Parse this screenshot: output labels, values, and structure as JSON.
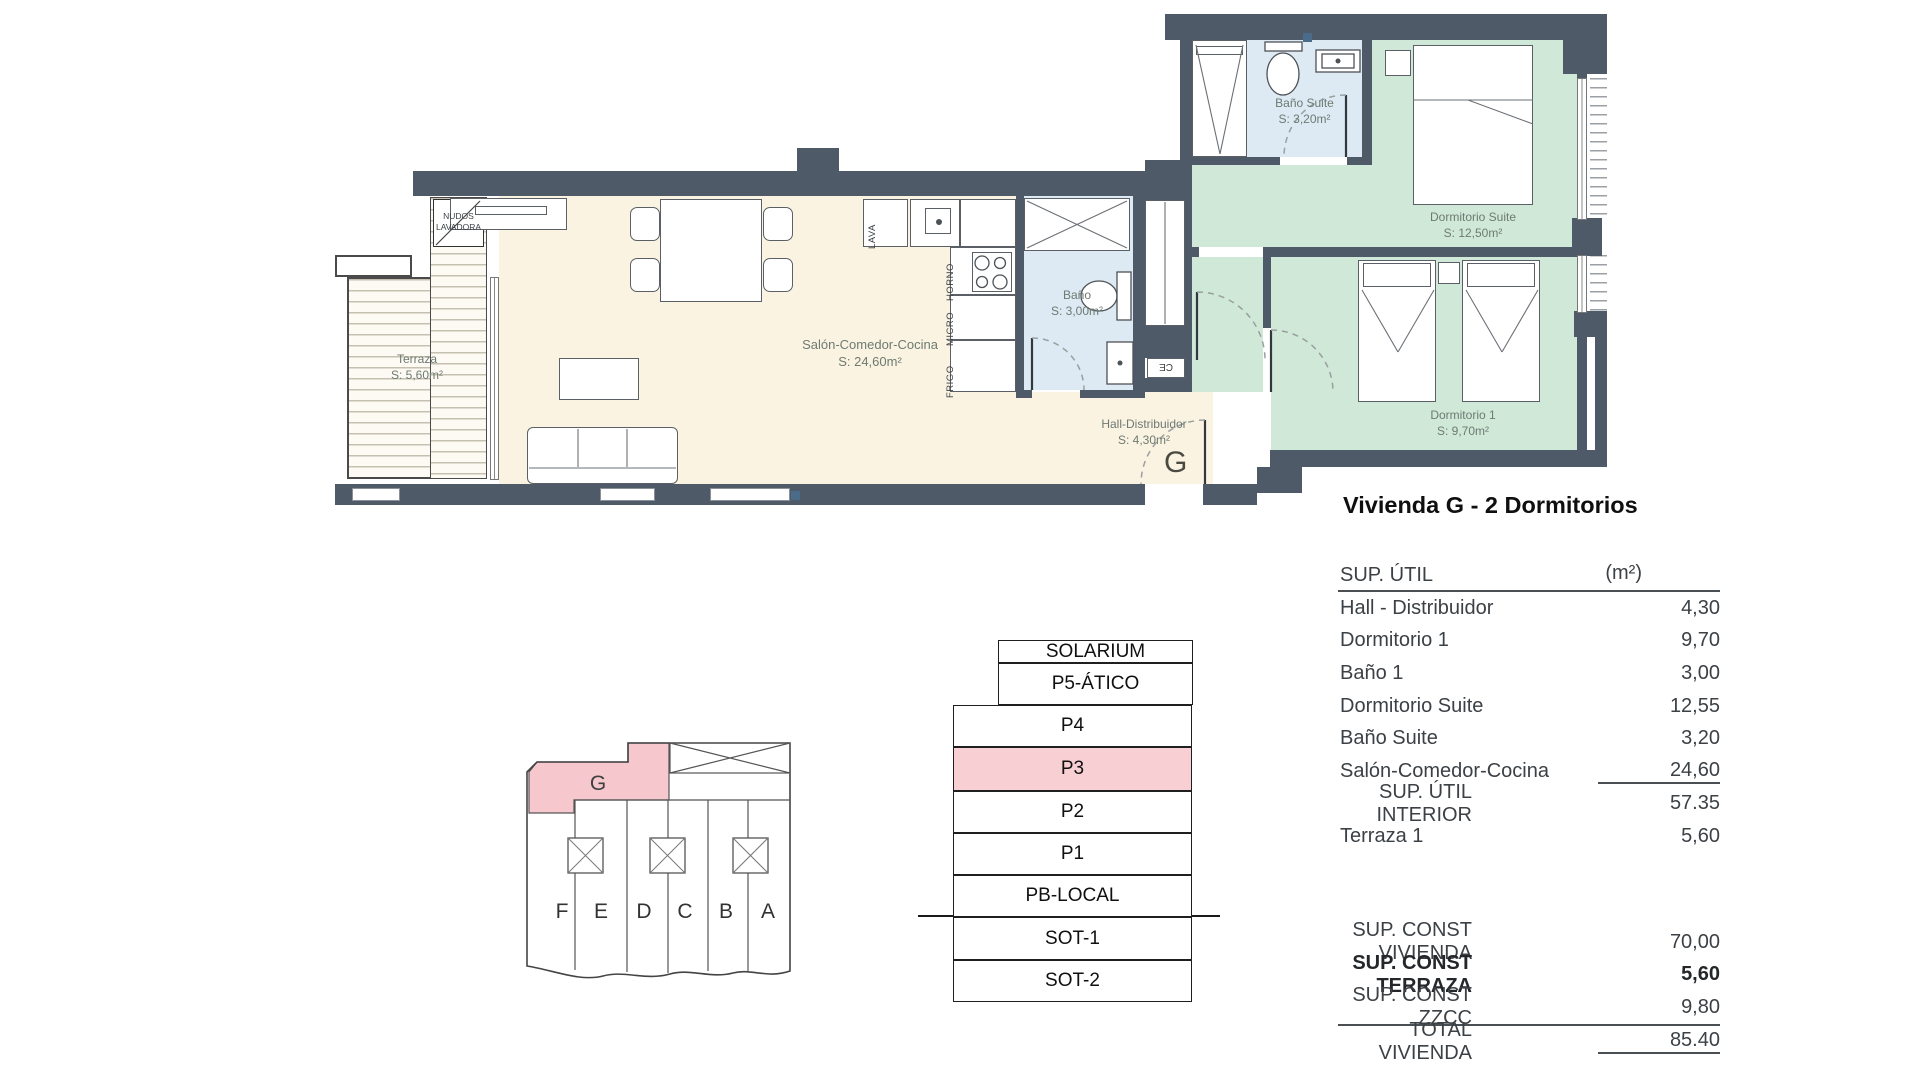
{
  "title": "Vivienda G - 2 Dormitorios",
  "plan": {
    "terraza": {
      "name": "Terraza",
      "area": "S: 5,60m²"
    },
    "lavadora": {
      "line1": "NUDOS",
      "line2": "LAVADORA"
    },
    "salon": {
      "name": "Salón-Comedor-Cocina",
      "area": "S: 24,60m²"
    },
    "bano": {
      "name": "Baño",
      "area": "S: 3,00m²"
    },
    "hall": {
      "name": "Hall-Distribuidor",
      "area": "S: 4,30m²",
      "letter": "G"
    },
    "bano_suite": {
      "name": "Baño Suite",
      "area": "S: 3,20m²"
    },
    "dorm_suite": {
      "name": "Dormitorio Suite",
      "area": "S: 12,50m²"
    },
    "dorm1": {
      "name": "Dormitorio 1",
      "area": "S: 9,70m²"
    },
    "kitchen": {
      "lava": "LAVA",
      "horno": "HORNO",
      "micro": "MICRO",
      "frigo": "FRIGO"
    },
    "shaft_label": "CE"
  },
  "table": {
    "header": {
      "label": "SUP. ÚTIL",
      "unit": "(m²)"
    },
    "rows": [
      {
        "label": "Hall - Distribuidor",
        "value": "4,30"
      },
      {
        "label": "Dormitorio 1",
        "value": "9,70"
      },
      {
        "label": "Baño 1",
        "value": "3,00"
      },
      {
        "label": "Dormitorio Suite",
        "value": "12,55"
      },
      {
        "label": "Baño Suite",
        "value": "3,20"
      },
      {
        "label": "Salón-Comedor-Cocina",
        "value": "24,60"
      },
      {
        "label": "SUP. ÚTIL INTERIOR",
        "value": "57.35"
      },
      {
        "label": "Terraza 1",
        "value": "5,60"
      }
    ],
    "totals": [
      {
        "label": "SUP. CONST VIVIENDA",
        "value": "70,00"
      },
      {
        "label": "SUP. CONST TERRAZA",
        "value": "5,60"
      },
      {
        "label": "SUP. CONST ZZCC",
        "value": "9,80"
      },
      {
        "label": "TOTAL VIVIENDA",
        "value": "85.40"
      }
    ]
  },
  "stack": {
    "floors": [
      {
        "label": "SOLARIUM"
      },
      {
        "label": "P5-ÁTICO"
      },
      {
        "label": "P4"
      },
      {
        "label": "P3",
        "highlight": true
      },
      {
        "label": "P2"
      },
      {
        "label": "P1"
      },
      {
        "label": "PB-LOCAL"
      },
      {
        "label": "SOT-1"
      },
      {
        "label": "SOT-2"
      }
    ]
  },
  "keyplan": {
    "highlight_unit": "G",
    "units": [
      "F",
      "E",
      "D",
      "C",
      "B",
      "A"
    ]
  },
  "colors": {
    "wall": "#4e5a67",
    "cream": "#faf3e2",
    "green": "#cfe8d8",
    "blue": "#dde9f3",
    "pink_floor": "#f8d0d3",
    "pink_unit": "#f6c8cd"
  }
}
